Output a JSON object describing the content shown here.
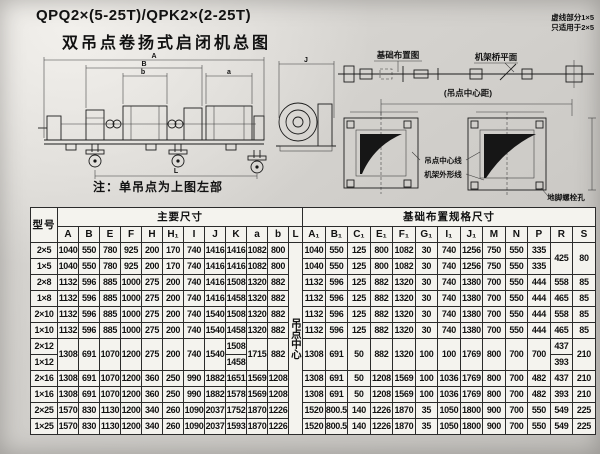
{
  "page": {
    "title_line1": "QPQ2×(5-25T)/QPK2×(2-25T)",
    "title_line2": "双吊点卷扬式启闭机总图",
    "note": "注：单吊点为上图左部"
  },
  "drawing": {
    "foundation_plan_label": "基础布置图",
    "frame_bridge_label": "机架桥平面",
    "dashed_note_line1": "虚线部分1×5",
    "dashed_note_line2": "只适用于2×5",
    "hoist_center_distance_label": "(吊点中心距)",
    "hoist_center_line_label": "吊点中心线",
    "frame_outline_label": "机架外形线",
    "anchor_bolt_label": "地脚螺栓孔",
    "dims": {
      "b": "b",
      "B": "B",
      "A": "A",
      "a": "a",
      "J": "J",
      "L": "L"
    }
  },
  "table": {
    "model_header": "型号",
    "group_main": "主要尺寸",
    "group_foundation": "基础布置规格尺寸",
    "main_cols": [
      "A",
      "B",
      "E",
      "F",
      "H",
      "H₁",
      "I",
      "J",
      "K",
      "a",
      "b",
      "L"
    ],
    "foundation_cols": [
      "A₁",
      "B₁",
      "C₁",
      "E₁",
      "F₁",
      "G₁",
      "I₁",
      "J₁",
      "M",
      "N",
      "P",
      "R",
      "S"
    ],
    "rows": [
      {
        "model": "2×5",
        "cells": [
          "1040",
          "550",
          "780",
          "925",
          "200",
          "170",
          "740",
          "1416",
          "1416",
          "1082",
          "800",
          {
            "v": "吊点中心",
            "rs": 12,
            "vert": true
          },
          "1040",
          "550",
          "125",
          "800",
          "1082",
          "30",
          "740",
          "1256",
          "750",
          "550",
          "335",
          {
            "v": "425",
            "rs": 2
          },
          {
            "v": "80",
            "rs": 2
          }
        ]
      },
      {
        "model": "1×5",
        "cells": [
          "1040",
          "550",
          "780",
          "925",
          "200",
          "170",
          "740",
          "1416",
          "1416",
          "1082",
          "800",
          "1040",
          "550",
          "125",
          "800",
          "1082",
          "30",
          "740",
          "1256",
          "750",
          "550",
          "335"
        ]
      },
      {
        "model": "2×8",
        "cells": [
          "1132",
          "596",
          "885",
          "1000",
          "275",
          "200",
          "740",
          "1416",
          "1508",
          "1320",
          "882",
          "1132",
          "596",
          "125",
          "882",
          "1320",
          "30",
          "740",
          "1380",
          "700",
          "550",
          "444",
          "558",
          "85"
        ]
      },
      {
        "model": "1×8",
        "cells": [
          "1132",
          "596",
          "885",
          "1000",
          "275",
          "200",
          "740",
          "1416",
          "1458",
          "1320",
          "882",
          "1132",
          "596",
          "125",
          "882",
          "1320",
          "30",
          "740",
          "1380",
          "700",
          "550",
          "444",
          "465",
          "85"
        ]
      },
      {
        "model": "2×10",
        "cells": [
          "1132",
          "596",
          "885",
          "1000",
          "275",
          "200",
          "740",
          "1540",
          "1508",
          "1320",
          "882",
          "1132",
          "596",
          "125",
          "882",
          "1320",
          "30",
          "740",
          "1380",
          "700",
          "550",
          "444",
          "558",
          "85"
        ]
      },
      {
        "model": "1×10",
        "cells": [
          "1132",
          "596",
          "885",
          "1000",
          "275",
          "200",
          "740",
          "1540",
          "1458",
          "1320",
          "882",
          "1132",
          "596",
          "125",
          "882",
          "1320",
          "30",
          "740",
          "1380",
          "700",
          "550",
          "444",
          "465",
          "85"
        ]
      },
      {
        "model": "2×12",
        "cells": [
          {
            "v": "1308",
            "rs": 2
          },
          {
            "v": "691",
            "rs": 2
          },
          {
            "v": "1070",
            "rs": 2
          },
          {
            "v": "1200",
            "rs": 2
          },
          {
            "v": "275",
            "rs": 2
          },
          {
            "v": "200",
            "rs": 2
          },
          {
            "v": "740",
            "rs": 2
          },
          {
            "v": "1540",
            "rs": 2
          },
          "1508",
          {
            "v": "1715",
            "rs": 2
          },
          {
            "v": "882",
            "rs": 2
          },
          {
            "v": "1308",
            "rs": 2
          },
          {
            "v": "691",
            "rs": 2
          },
          {
            "v": "50",
            "rs": 2
          },
          {
            "v": "882",
            "rs": 2
          },
          {
            "v": "1320",
            "rs": 2
          },
          {
            "v": "100",
            "rs": 2
          },
          {
            "v": "100",
            "rs": 2
          },
          {
            "v": "1769",
            "rs": 2
          },
          {
            "v": "800",
            "rs": 2
          },
          {
            "v": "700",
            "rs": 2
          },
          {
            "v": "700",
            "rs": 2
          },
          "437",
          {
            "v": "210",
            "rs": 2
          }
        ]
      },
      {
        "model": "1×12",
        "cells": [
          "1458",
          "393"
        ]
      },
      {
        "model": "2×16",
        "cells": [
          "1308",
          "691",
          "1070",
          "1200",
          "360",
          "250",
          "990",
          "1882",
          "1651",
          "1569",
          "1208",
          "1308",
          "691",
          "50",
          "1208",
          "1569",
          "100",
          "1036",
          "1769",
          "800",
          "700",
          "482",
          "437",
          "210"
        ]
      },
      {
        "model": "1×16",
        "cells": [
          "1308",
          "691",
          "1070",
          "1200",
          "360",
          "250",
          "990",
          "1882",
          "1578",
          "1569",
          "1208",
          "1308",
          "691",
          "50",
          "1208",
          "1569",
          "100",
          "1036",
          "1769",
          "800",
          "700",
          "482",
          "393",
          "210"
        ]
      },
      {
        "model": "2×25",
        "cells": [
          "1570",
          "830",
          "1130",
          "1200",
          "340",
          "260",
          "1090",
          "2037",
          "1752",
          "1870",
          "1226",
          "1520",
          "800.5",
          "140",
          "1226",
          "1870",
          "35",
          "1050",
          "1800",
          "900",
          "700",
          "550",
          "549",
          "225"
        ]
      },
      {
        "model": "1×25",
        "cells": [
          "1570",
          "830",
          "1130",
          "1200",
          "340",
          "260",
          "1090",
          "2037",
          "1593",
          "1870",
          "1226",
          "1520",
          "800.5",
          "140",
          "1226",
          "1870",
          "35",
          "1050",
          "1800",
          "900",
          "700",
          "550",
          "549",
          "225"
        ]
      }
    ]
  }
}
